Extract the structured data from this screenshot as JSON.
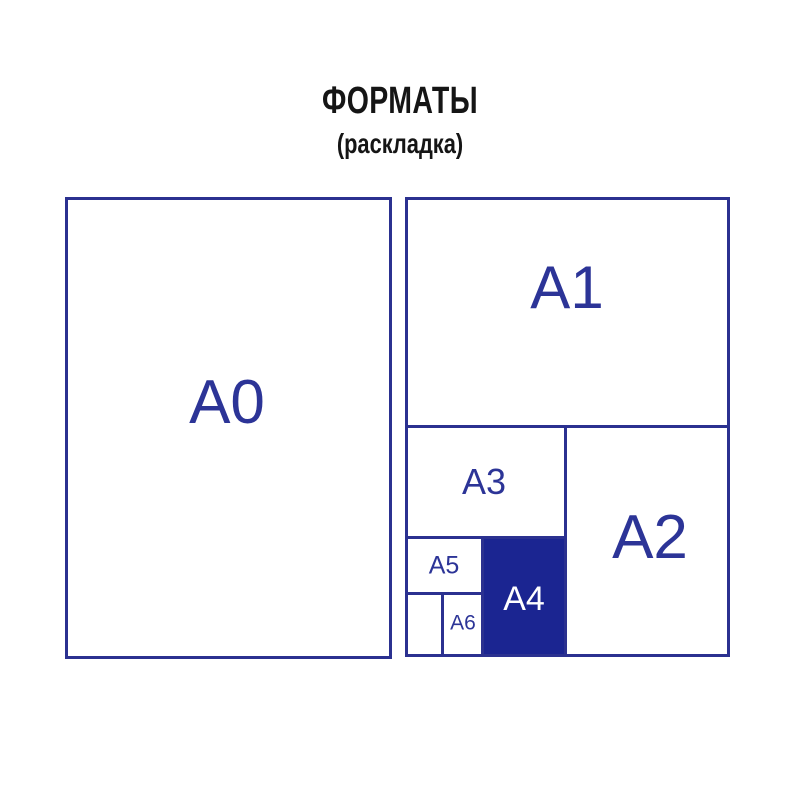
{
  "header": {
    "title": "ФОРМАТЫ",
    "subtitle": "(раскладка)"
  },
  "colors": {
    "line_blue": "#2b3190",
    "label_blue": "#2c3497",
    "a4_fill_navy": "#1b2591",
    "a4_label_white": "#ffffff",
    "title_black": "#151515",
    "background": "#ffffff"
  },
  "diagram": {
    "description": "Nested layout of paper sheet formats A0–A6; A4 cell is filled solid navy",
    "formats": [
      {
        "id": "a0",
        "label": "A0",
        "filled": false
      },
      {
        "id": "a1",
        "label": "A1",
        "filled": false
      },
      {
        "id": "a2",
        "label": "A2",
        "filled": false
      },
      {
        "id": "a3",
        "label": "A3",
        "filled": false
      },
      {
        "id": "a4",
        "label": "A4",
        "filled": true
      },
      {
        "id": "a5",
        "label": "A5",
        "filled": false
      },
      {
        "id": "a6",
        "label": "A6",
        "filled": false
      }
    ]
  }
}
